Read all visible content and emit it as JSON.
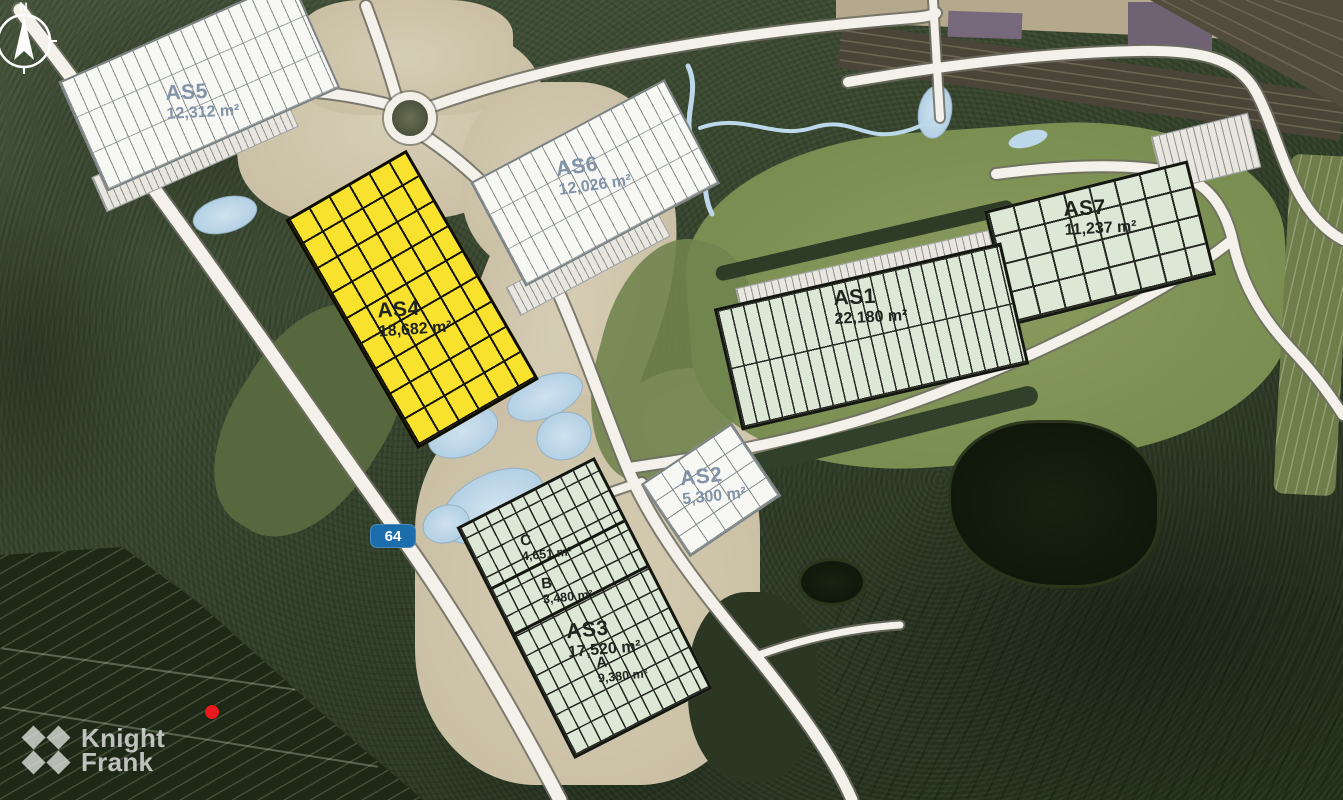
{
  "map": {
    "compass": {
      "north_label": "N"
    },
    "road_badge": {
      "number": "64"
    },
    "logo": {
      "line1": "Knight",
      "line2": "Frank"
    },
    "buildings": [
      {
        "id": "AS5",
        "area": "12,312 m²",
        "fill": "#f7f7f4"
      },
      {
        "id": "AS6",
        "area": "12,026 m²",
        "fill": "#f7f7f4"
      },
      {
        "id": "AS7",
        "area": "11,237 m²",
        "fill": "#dde7d5"
      },
      {
        "id": "AS1",
        "area": "22,180 m²",
        "fill": "#dde7d5"
      },
      {
        "id": "AS4",
        "area": "18,682 m²",
        "fill": "#f9e22e"
      },
      {
        "id": "AS2",
        "area": "5,300 m²",
        "fill": "#f7f7f4"
      },
      {
        "id": "AS3",
        "area": "17,520 m²",
        "fill": "#dde7d5",
        "units": [
          {
            "id": "C",
            "area": "4,651 m²"
          },
          {
            "id": "B",
            "area": "3,480 m²"
          },
          {
            "id": "A",
            "area": "9,380 m²"
          }
        ]
      }
    ],
    "colors": {
      "highlight_yellow": "#f9e22e",
      "available_white": "#f7f7f4",
      "unit_green": "#dde7d5",
      "label_blue_gray": "#8293a7",
      "label_dark": "#20241f",
      "road_badge_blue": "#1b6dab",
      "marker_red": "#e81a1d",
      "pond_blue": "#b7d2e6"
    }
  }
}
